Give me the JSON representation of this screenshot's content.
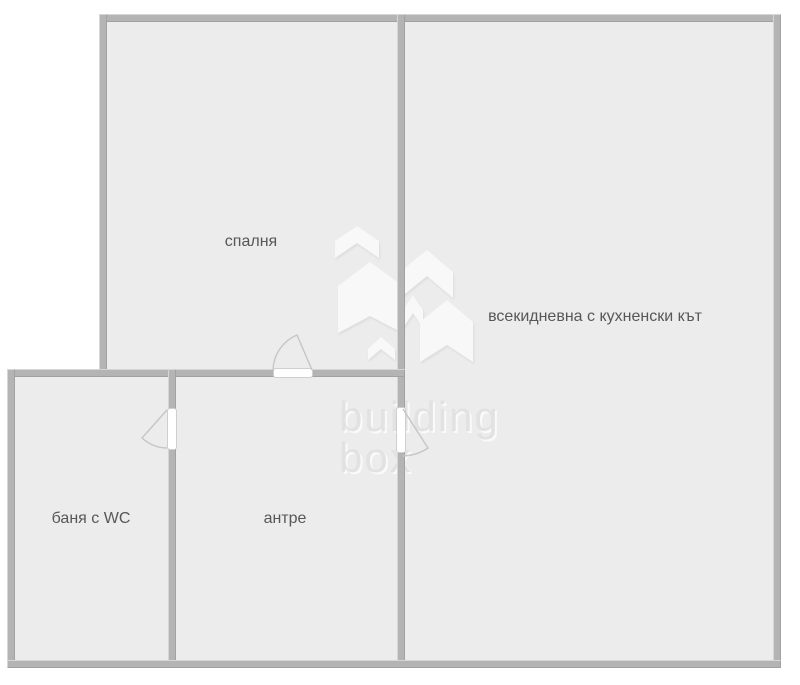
{
  "floorplan": {
    "rooms": [
      {
        "id": "bedroom",
        "label": "спалня"
      },
      {
        "id": "living",
        "label": "всекидневна с кухненски кът"
      },
      {
        "id": "bathroom",
        "label": "баня с WC"
      },
      {
        "id": "hall",
        "label": "антре"
      }
    ],
    "doors": [
      {
        "id": "door-bedroom",
        "between": "hall-bedroom"
      },
      {
        "id": "door-bathroom",
        "between": "hall-bathroom"
      },
      {
        "id": "door-living",
        "between": "hall-living"
      }
    ],
    "watermark": {
      "line1": "building",
      "line2": "box"
    },
    "colors": {
      "background": "#ffffff",
      "floor": "#ececec",
      "wall": "#b4b4b4",
      "label_text": "#575757",
      "door_swing": "#c6c6c6",
      "watermark_text": "#e2e2e2",
      "watermark_shape": "#f8f8f8"
    }
  }
}
